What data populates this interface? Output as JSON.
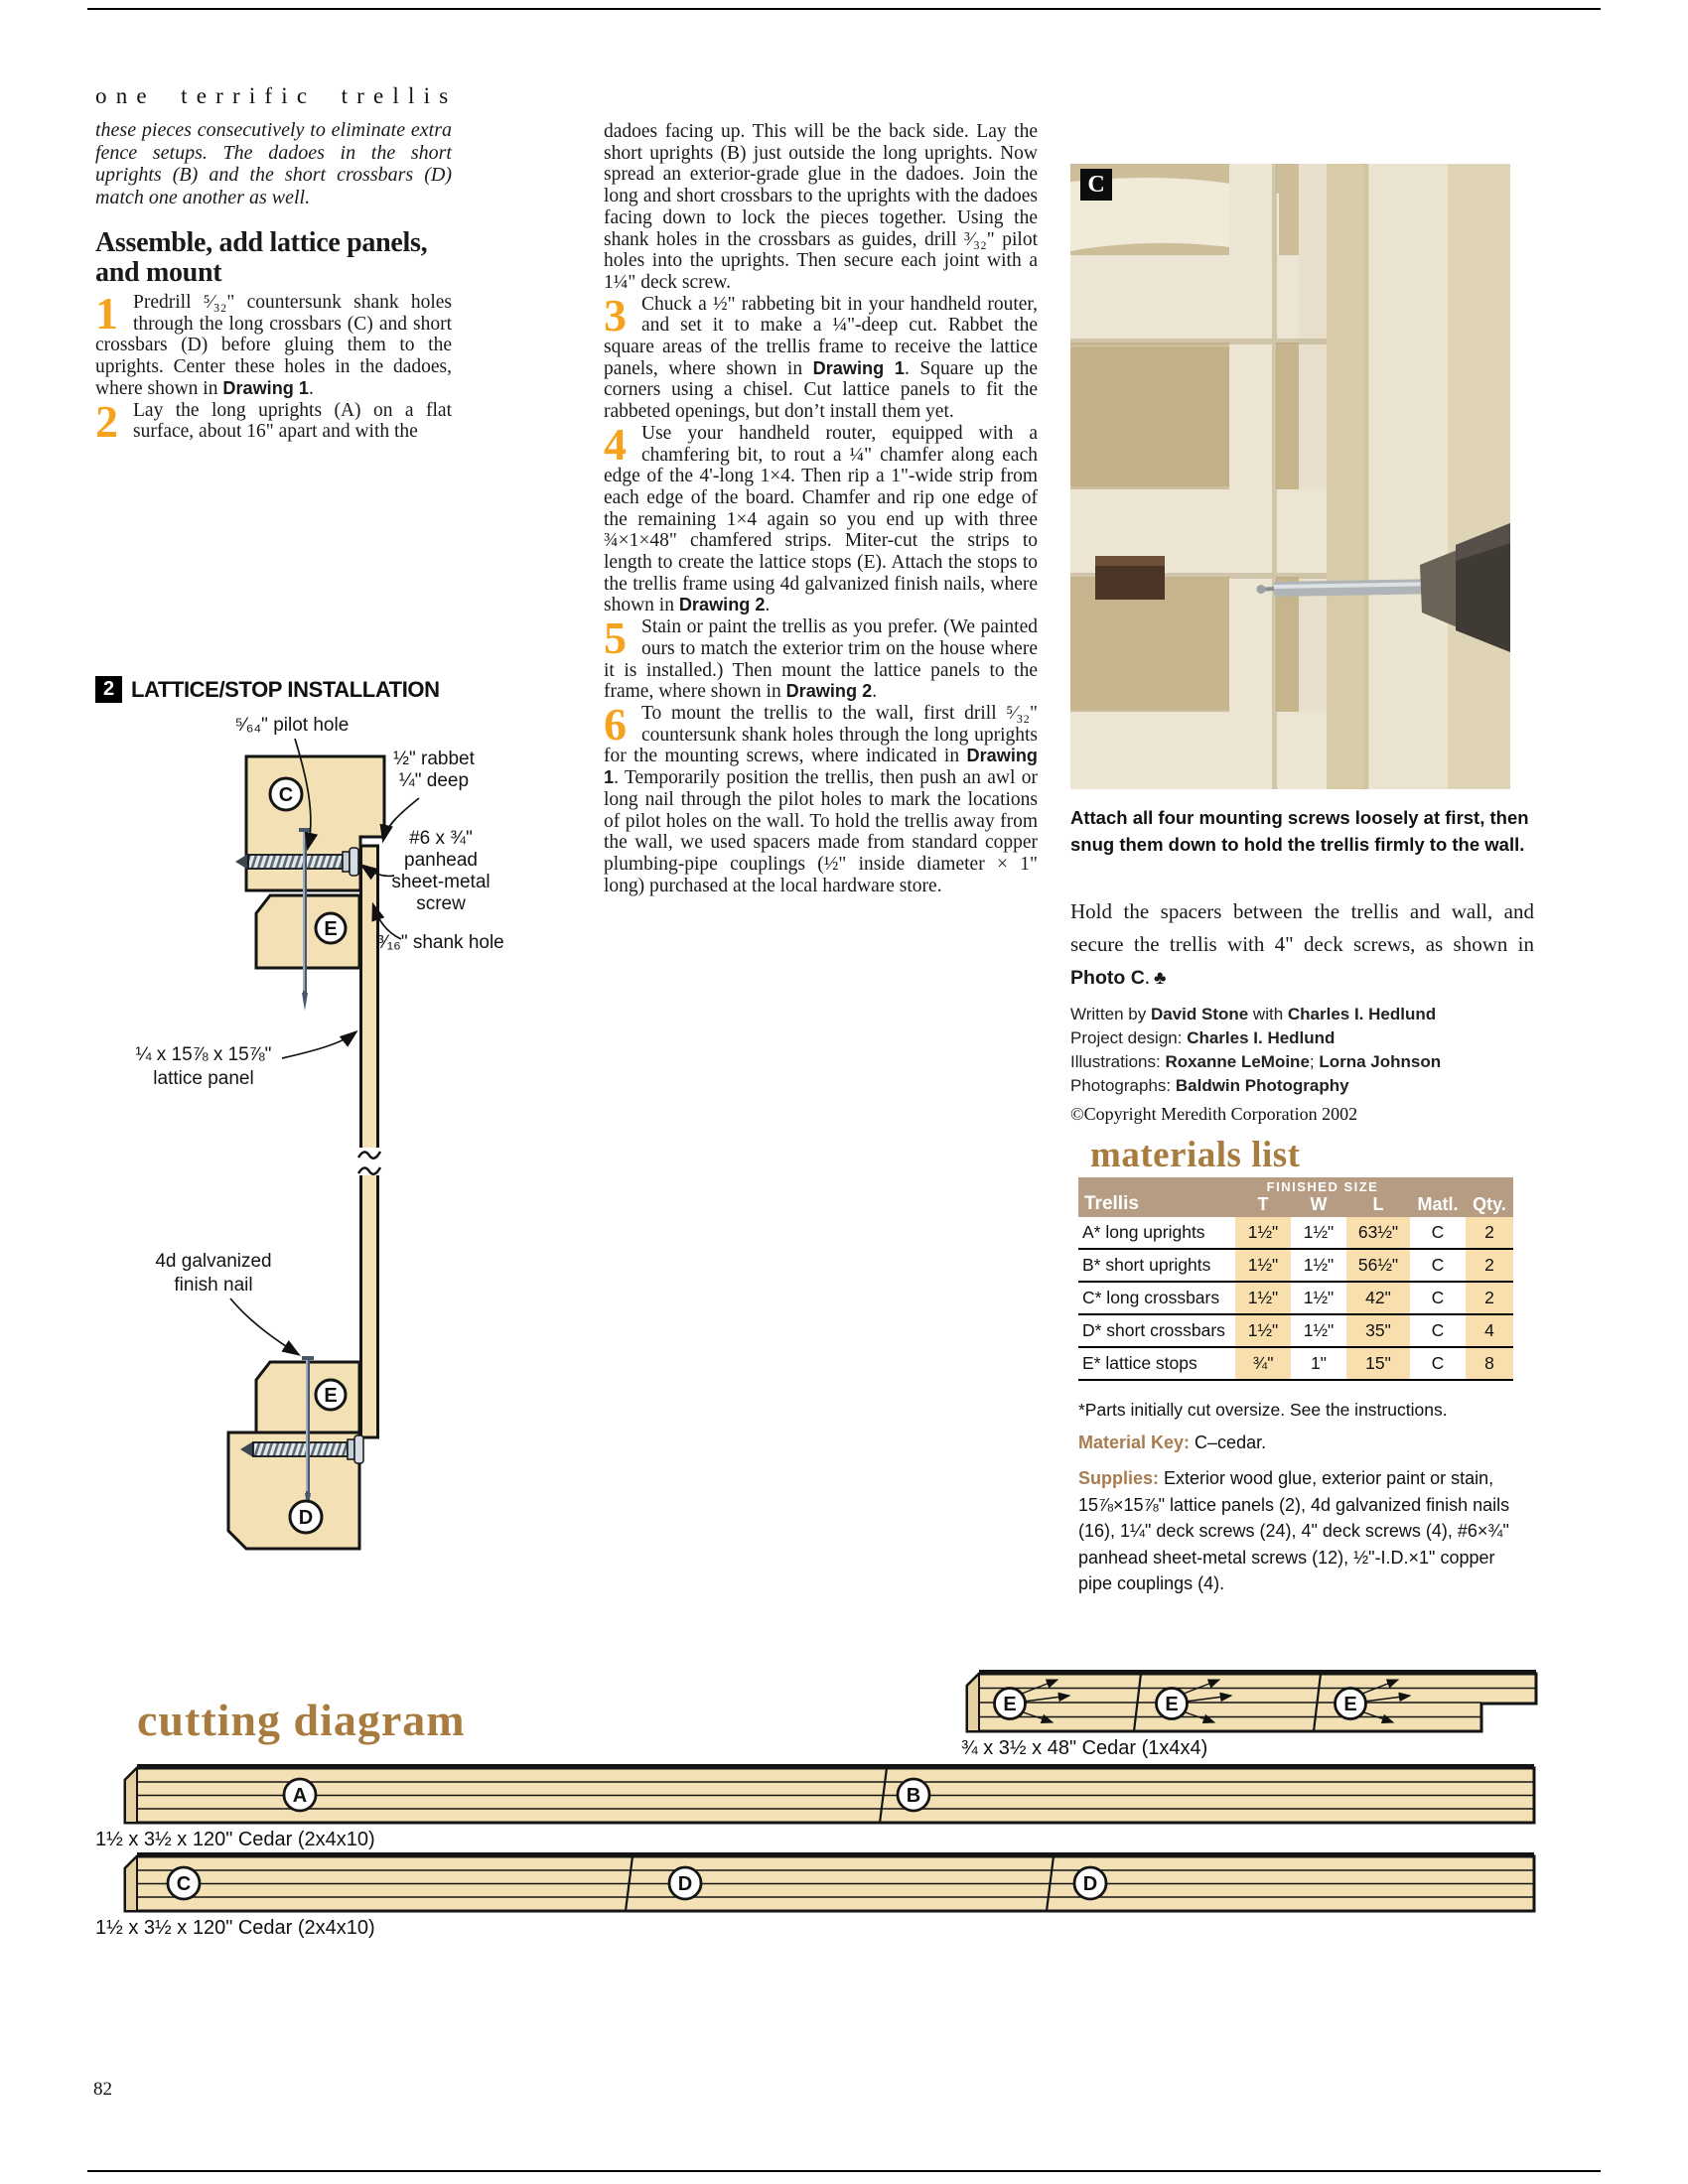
{
  "colors": {
    "accent_orange": "#f6a21d",
    "heading_brown": "#a87c3e",
    "wood_fill": "#f3e1b5",
    "table_header": "#b69c83",
    "column_highlight": "#f9dfad",
    "photo_wall_tan": "#cdbd99",
    "trellis_cream": "#ece5d4",
    "copper_spacer": "#4a3526"
  },
  "page": {
    "number": "82"
  },
  "header": {
    "title": "one terrific trellis"
  },
  "left_column": {
    "intro": "these pieces consecutively to eliminate extra fence setups. The dadoes in the short uprights (B) and the short crossbars (D) match one another as well.",
    "heading": "Assemble, add lattice panels, and mount",
    "steps": [
      {
        "num": "1",
        "segments": [
          {
            "t": "Predrill ⁵⁄₃₂\" countersunk shank holes through the long crossbars (C) and short crossbars (D) before gluing them to the uprights. Center these holes in the dadoes, where shown in ",
            "b": false
          },
          {
            "t": "Drawing 1",
            "b": true
          },
          {
            "t": ".",
            "b": false
          }
        ]
      },
      {
        "num": "2",
        "segments": [
          {
            "t": "Lay the long uprights (A) on a flat surface, about 16\" apart and with the",
            "b": false
          }
        ]
      }
    ]
  },
  "middle_column": {
    "continuation": [
      {
        "t": "dadoes facing up. This will be the back side. Lay the short uprights (B) just outside the long uprights. Now spread an exterior-grade glue in the dadoes. Join the long and short crossbars to the uprights with the dadoes facing down to lock the pieces together. Using the shank holes in the crossbars as guides, drill ³⁄₃₂\" pilot holes into the uprights. Then secure each joint with a 1¼\" deck screw.",
        "b": false
      }
    ],
    "steps": [
      {
        "num": "3",
        "segments": [
          {
            "t": "Chuck a ½\" rabbeting bit in your handheld router, and set it to make a ¼\"-deep cut. Rabbet the square areas of the trellis frame to receive the lattice panels, where shown in ",
            "b": false
          },
          {
            "t": "Drawing 1",
            "b": true
          },
          {
            "t": ". Square up the corners using a chisel. Cut lattice panels to fit the rabbeted openings, but don’t install them yet.",
            "b": false
          }
        ]
      },
      {
        "num": "4",
        "segments": [
          {
            "t": "Use your handheld router, equipped with a chamfering bit, to rout a ¼\" chamfer along each edge of the 4'-long 1×4. Then rip a 1\"-wide strip from each edge of the board. Chamfer and rip one edge of the remaining 1×4 again so you end up with three ¾×1×48\" chamfered strips. Miter-cut the strips to length to create the lattice stops (E). Attach the stops to the trellis frame using 4d galvanized finish nails, where shown in ",
            "b": false
          },
          {
            "t": "Drawing 2",
            "b": true
          },
          {
            "t": ".",
            "b": false
          }
        ]
      },
      {
        "num": "5",
        "segments": [
          {
            "t": "Stain or paint the trellis as you prefer. (We painted ours to match the exterior trim on the house where it is installed.) Then mount the lattice panels to the frame, where shown in ",
            "b": false
          },
          {
            "t": "Drawing 2",
            "b": true
          },
          {
            "t": ".",
            "b": false
          }
        ]
      },
      {
        "num": "6",
        "segments": [
          {
            "t": "To mount the trellis to the wall, first drill ⁵⁄₃₂\" countersunk shank holes through the long uprights for the mounting screws, where indicated in ",
            "b": false
          },
          {
            "t": "Drawing 1",
            "b": true
          },
          {
            "t": ". Temporarily position the trellis, then push an awl or long nail through the pilot holes to mark the locations of pilot holes on the wall. To hold the trellis away from the wall, we used spacers made from standard copper plumbing-pipe couplings (½\" inside diameter × 1\" long) purchased at the local hardware store.",
            "b": false
          }
        ]
      }
    ]
  },
  "drawing": {
    "number": "2",
    "title": "LATTICE/STOP INSTALLATION",
    "parts": {
      "c": "C",
      "e": "E",
      "d": "D"
    },
    "labels": {
      "pilot_hole": "⁵⁄₆₄\" pilot hole",
      "rabbet_line1": "½\" rabbet",
      "rabbet_line2": "¼\" deep",
      "screw_line1": "#6 x ¾\"",
      "screw_line2": "panhead",
      "screw_line3": "sheet-metal",
      "screw_line4": "screw",
      "shank_hole": "³⁄₁₆\" shank hole",
      "lattice_line1": "¼ x 15⅞ x 15⅞\"",
      "lattice_line2": "lattice panel",
      "nail_line1": "4d galvanized",
      "nail_line2": "finish nail"
    }
  },
  "photo": {
    "label": "C",
    "caption": "Attach all four mounting screws loosely at first, then snug them down to hold the trellis firmly to the wall."
  },
  "closing": {
    "segments": [
      {
        "t": "Hold the spacers between the trellis and wall, and secure the trellis with 4\" deck screws, as shown in ",
        "b": false
      },
      {
        "t": "Photo C",
        "b": true
      },
      {
        "t": ".",
        "b": false
      }
    ],
    "end_mark": "♣"
  },
  "credits": {
    "lines": [
      [
        {
          "t": "Written by ",
          "b": false
        },
        {
          "t": "David Stone",
          "b": true
        },
        {
          "t": " with ",
          "b": false
        },
        {
          "t": "Charles I. Hedlund",
          "b": true
        }
      ],
      [
        {
          "t": "Project design: ",
          "b": false
        },
        {
          "t": "Charles I. Hedlund",
          "b": true
        }
      ],
      [
        {
          "t": "Illustrations: ",
          "b": false
        },
        {
          "t": "Roxanne LeMoine",
          "b": true
        },
        {
          "t": "; ",
          "b": false
        },
        {
          "t": "Lorna Johnson",
          "b": true
        }
      ],
      [
        {
          "t": "Photographs: ",
          "b": false
        },
        {
          "t": "Baldwin Photography",
          "b": true
        }
      ]
    ],
    "copyright": "©Copyright Meredith Corporation 2002"
  },
  "materials": {
    "title": "materials list",
    "table": {
      "group_header": "FINISHED SIZE",
      "headers": {
        "trellis": "Trellis",
        "t": "T",
        "w": "W",
        "l": "L",
        "matl": "Matl.",
        "qty": "Qty."
      },
      "rows": [
        [
          "A* long uprights",
          "1½\"",
          "1½\"",
          "63½\"",
          "C",
          "2"
        ],
        [
          "B* short uprights",
          "1½\"",
          "1½\"",
          "56½\"",
          "C",
          "2"
        ],
        [
          "C* long crossbars",
          "1½\"",
          "1½\"",
          "42\"",
          "C",
          "2"
        ],
        [
          "D* short crossbars",
          "1½\"",
          "1½\"",
          "35\"",
          "C",
          "4"
        ],
        [
          "E* lattice stops",
          "¾\"",
          "1\"",
          "15\"",
          "C",
          "8"
        ]
      ]
    },
    "footnote": "*Parts initially cut oversize. See the instructions.",
    "material_key_label": "Material Key:",
    "material_key_value": " C–cedar.",
    "supplies_label": "Supplies:",
    "supplies_value": " Exterior wood glue, exterior paint or stain, 15⅞×15⅞\" lattice panels (2), 4d galvanized finish nails (16), 1¼\" deck screws (24), 4\" deck screws (4), #6×¾\" panhead sheet-metal screws (12), ½\"-I.D.×1\" copper pipe couplings (4).",
    "material_key_full": "Material Key: C–cedar."
  },
  "cutting": {
    "title": "cutting diagram",
    "boards": [
      {
        "caption": "¾ x 3½ x 48\" Cedar (1x4x4)",
        "parts": [
          "E",
          "E",
          "E"
        ]
      },
      {
        "caption": "1½ x 3½ x 120\" Cedar (2x4x10)",
        "parts": [
          "A",
          "B"
        ]
      },
      {
        "caption": "1½ x 3½ x 120\" Cedar (2x4x10)",
        "parts": [
          "C",
          "D",
          "D"
        ]
      }
    ]
  }
}
